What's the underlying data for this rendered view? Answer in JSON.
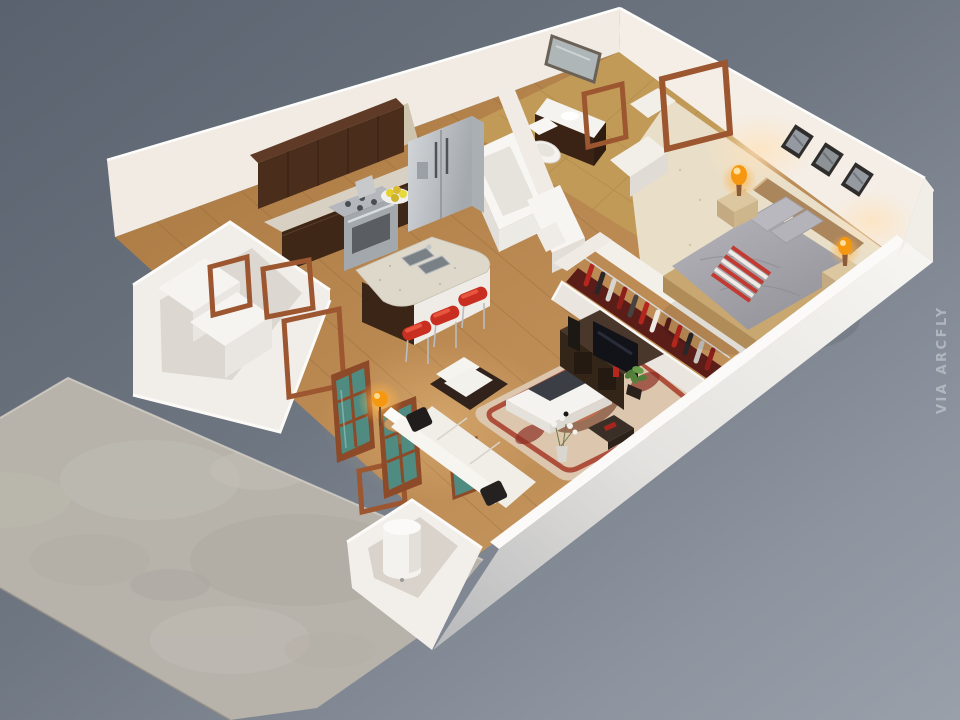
{
  "scene": {
    "type": "3d-isometric-floor-plan-render",
    "description": "Photorealistic dollhouse-view 3D floor plan of a one-bedroom apartment on a gray studio background with a concrete patio slab",
    "watermark": {
      "text": "VIA ARCFLY"
    },
    "rooms": [
      "kitchen",
      "living-room",
      "bathroom",
      "hallway",
      "walk-through-closet",
      "bedroom",
      "laundry-nook",
      "water-heater-closet",
      "patio"
    ],
    "objects": [
      "upper-cabinets",
      "range-oven",
      "refrigerator",
      "kitchen-island-with-sink",
      "bar-stools-red",
      "fruit-plate",
      "bathtub",
      "toilet",
      "vanity-with-mirror",
      "washer-dryer",
      "open-door-frames",
      "french-doors-teal-glass",
      "patio-lamp",
      "patio-side-table",
      "water-heater-cylinder",
      "sofa-white",
      "black-throw-pillows",
      "armchair",
      "coffee-table",
      "white-flower-vase",
      "area-rug",
      "tv-console",
      "flat-tv",
      "house-plant",
      "hanging-clothes-rail",
      "bed-with-gray-duvet",
      "striped-throw-blanket",
      "headboard",
      "nightstands",
      "glowing-orange-lamps",
      "wall-picture-frames"
    ]
  },
  "palette": {
    "bg_top": "#59626e",
    "bg_mid": "#6e7681",
    "bg_light": "#99a0aa",
    "concrete": "#b7b3ab",
    "concrete_edge": "#d2cec6",
    "wall_lit": "#f4eee7",
    "wall_mid": "#f1ebe3",
    "wall_bright": "#fbfaf8",
    "wall_shade": "#ddd7d0",
    "wood": "#b5834f",
    "wood_dark": "#8f6437",
    "wood_light": "#d8ad72",
    "tile": "#c19a57",
    "carpet": "#e9dfc9",
    "carpet_speck": "#d2c5a4",
    "cabinet": "#46291a",
    "cabinet_top": "#5f3b27",
    "granite": "#d8d1c3",
    "stainless": "#c0c4c8",
    "stool_red": "#c92f20",
    "sofa_white": "#f1eee8",
    "sofa_dark": "#31231b",
    "pillow_black": "#1d1b1a",
    "rug_cream": "#dcc7ae",
    "rug_red": "#a63a28",
    "rug_brown": "#7c4a33",
    "tv_black": "#121318",
    "console_brown": "#3a2a20",
    "plant_green": "#4f7d3a",
    "bed_gray": "#a5a4ab",
    "pillow_gray": "#b9b8bf",
    "bed_frame": "#c9a771",
    "headboard": "#ab855c",
    "nightstand": "#dcc7a1",
    "lamp_orange": "#f6980f",
    "lamp_glow": "#ffb347",
    "door_wood": "#9c5630",
    "glass_teal": "#4f8b81",
    "clothes_red": "#a6251f",
    "throw_red": "#c23b32",
    "watermark": "#b6bbc3"
  }
}
